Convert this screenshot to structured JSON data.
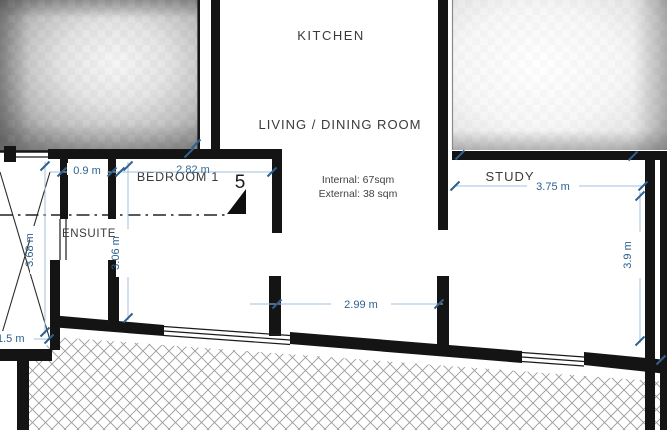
{
  "drawing": {
    "type": "floor-plan",
    "unit_number": "5",
    "rooms": {
      "kitchen": {
        "label": "KITCHEN"
      },
      "living_dining": {
        "label": "LIVING / DINING ROOM"
      },
      "bedroom1": {
        "label": "BEDROOM 1"
      },
      "ensuite": {
        "label": "ENSUITE"
      },
      "study": {
        "label": "STUDY"
      }
    },
    "area_note": {
      "internal": "Internal: 67sqm",
      "external": "External: 38 sqm"
    },
    "dimensions": {
      "closet_width": "0.9 m",
      "bedroom_width": "2.82 m",
      "study_width": "3.75 m",
      "terrace_opening": "2.99 m",
      "left_offset": "1.5 m",
      "left_height": "3.68 m",
      "bedroom_height": "3.06 m",
      "study_height": "3.9 m"
    },
    "colors": {
      "wall": "#141414",
      "dimension_accent": "#2e618f",
      "dimension_line": "#a3c0dc",
      "hatch": "#9b9b9b",
      "label_text": "#3a3a3a"
    }
  }
}
